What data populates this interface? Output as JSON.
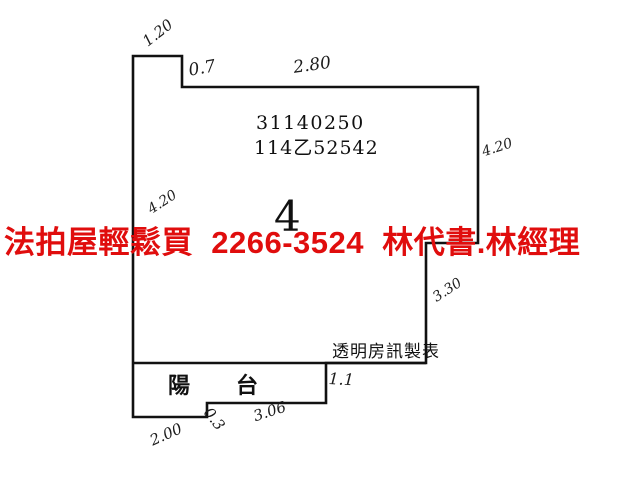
{
  "watermark": {
    "text": "法拍屋輕鬆買  2266-3524  林代書.林經理",
    "color": "#e00d0d"
  },
  "plan": {
    "parcel_number": "31140250",
    "registration_number": "114乙52542",
    "unit_number": "4",
    "balcony_label": "陽      台",
    "source_label": "透明房訊製表",
    "measurements": {
      "notch_top": "1.20",
      "notch_depth": "0.7",
      "top_edge": "2.80",
      "right_wall": "4.20",
      "left_wall": "4.20",
      "right_step": "3.30",
      "balcony_right": "1.1",
      "balcony_bottom_left": "2.00",
      "balcony_step": "0.3",
      "balcony_bottom_right": "3.06"
    }
  },
  "colors": {
    "wall_line": "#111111",
    "background": "#ffffff"
  }
}
